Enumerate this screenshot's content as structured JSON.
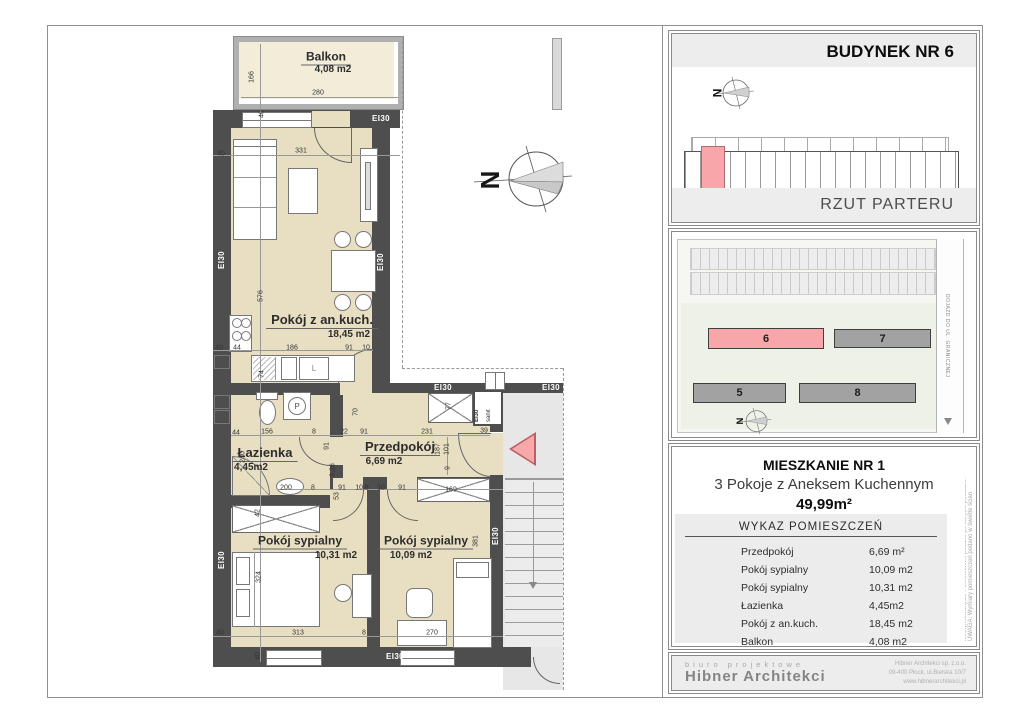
{
  "colors": {
    "highlight_pink": "#f8a6aa",
    "wall_gray": "#4e4e4e",
    "floor_beige": "#e8dfc3"
  },
  "plan": {
    "fire_rating_label": "EI30",
    "sanit_shaft_labels": [
      "EI30",
      "sanit"
    ],
    "north_letter": "N",
    "kitchen_sink_label": "L",
    "washer_label": "P",
    "rooms": [
      {
        "name": "Balkon",
        "area": "4,08 m2",
        "nx": 326,
        "ny": 58,
        "ax": 333,
        "ay": 70,
        "fs": 12
      },
      {
        "name": "Pokój z an.kuch.",
        "area": "18,45 m2",
        "nx": 322,
        "ny": 321,
        "ax": 349,
        "ay": 335,
        "fs": 13
      },
      {
        "name": "Łazienka",
        "area": "4,45m2",
        "nx": 265,
        "ny": 454,
        "ax": 251,
        "ay": 468,
        "fs": 13
      },
      {
        "name": "Przedpokój",
        "area": "6,69 m2",
        "nx": 400,
        "ny": 448,
        "ax": 384,
        "ay": 462,
        "fs": 13
      },
      {
        "name": "Pokój sypialny",
        "area": "10,31 m2",
        "nx": 300,
        "ny": 542,
        "ax": 336,
        "ay": 556,
        "fs": 12
      },
      {
        "name": "Pokój sypialny",
        "area": "10,09 m2",
        "nx": 426,
        "ny": 542,
        "ax": 411,
        "ay": 556,
        "fs": 12
      }
    ],
    "fire_labels": [
      {
        "x": 381,
        "y": 119,
        "r": 0
      },
      {
        "x": 222,
        "y": 260,
        "r": 1
      },
      {
        "x": 381,
        "y": 262,
        "r": 1
      },
      {
        "x": 443,
        "y": 388,
        "r": 0
      },
      {
        "x": 551,
        "y": 388,
        "r": 0
      },
      {
        "x": 222,
        "y": 560,
        "r": 1
      },
      {
        "x": 496,
        "y": 536,
        "r": 1
      },
      {
        "x": 395,
        "y": 657,
        "r": 0
      }
    ],
    "dims": [
      {
        "t": "40",
        "x": 221,
        "y": 154
      },
      {
        "t": "331",
        "x": 301,
        "y": 151
      },
      {
        "t": "166",
        "x": 252,
        "y": 77,
        "r": 1
      },
      {
        "t": "280",
        "x": 318,
        "y": 93
      },
      {
        "t": "40",
        "x": 262,
        "y": 114,
        "r": 1
      },
      {
        "t": "576",
        "x": 261,
        "y": 296,
        "r": 1
      },
      {
        "t": "40",
        "x": 219,
        "y": 348
      },
      {
        "t": "44",
        "x": 237,
        "y": 348
      },
      {
        "t": "186",
        "x": 292,
        "y": 348
      },
      {
        "t": "91",
        "x": 349,
        "y": 348
      },
      {
        "t": "10",
        "x": 366,
        "y": 348
      },
      {
        "t": "74",
        "x": 262,
        "y": 374,
        "r": 1
      },
      {
        "t": "70",
        "x": 356,
        "y": 412,
        "r": 1
      },
      {
        "t": "44",
        "x": 236,
        "y": 433
      },
      {
        "t": "156",
        "x": 267,
        "y": 432
      },
      {
        "t": "8",
        "x": 314,
        "y": 432
      },
      {
        "t": "22",
        "x": 344,
        "y": 432
      },
      {
        "t": "91",
        "x": 364,
        "y": 432
      },
      {
        "t": "231",
        "x": 427,
        "y": 432
      },
      {
        "t": "39",
        "x": 484,
        "y": 431
      },
      {
        "t": "240",
        "x": 243,
        "y": 457,
        "r": 1
      },
      {
        "t": "91",
        "x": 327,
        "y": 446,
        "r": 1
      },
      {
        "t": "8,26",
        "x": 333,
        "y": 470,
        "r": 1
      },
      {
        "t": "53",
        "x": 337,
        "y": 496,
        "r": 1
      },
      {
        "t": "200",
        "x": 286,
        "y": 488
      },
      {
        "t": "8",
        "x": 313,
        "y": 488
      },
      {
        "t": "91",
        "x": 342,
        "y": 488
      },
      {
        "t": "10,8",
        "x": 362,
        "y": 488
      },
      {
        "t": "10",
        "x": 381,
        "y": 488
      },
      {
        "t": "91",
        "x": 402,
        "y": 488
      },
      {
        "t": "187",
        "x": 438,
        "y": 449,
        "r": 1
      },
      {
        "t": "101",
        "x": 447,
        "y": 449,
        "r": 1
      },
      {
        "t": "9",
        "x": 448,
        "y": 468,
        "r": 1
      },
      {
        "t": "77",
        "x": 449,
        "y": 406,
        "r": 1
      },
      {
        "t": "169",
        "x": 451,
        "y": 490
      },
      {
        "t": "42",
        "x": 258,
        "y": 513,
        "r": 1
      },
      {
        "t": "324",
        "x": 259,
        "y": 577,
        "r": 1
      },
      {
        "t": "381",
        "x": 476,
        "y": 541,
        "r": 1
      },
      {
        "t": "40",
        "x": 220,
        "y": 633
      },
      {
        "t": "313",
        "x": 298,
        "y": 633
      },
      {
        "t": "8",
        "x": 364,
        "y": 633
      },
      {
        "t": "270",
        "x": 432,
        "y": 633
      },
      {
        "t": "40",
        "x": 258,
        "y": 656,
        "r": 1
      }
    ]
  },
  "panel_building": {
    "title": "BUDYNEK NR 6",
    "subtitle": "RZUT PARTERU"
  },
  "panel_site": {
    "building_numbers": {
      "b5": "5",
      "b6": "6",
      "b7": "7",
      "b8": "8"
    },
    "road_label": "DOJAZD DO UL. GRANICZNEJ"
  },
  "panel_info": {
    "title": "MIESZKANIE NR 1",
    "subtitle": "3 Pokoje z Aneksem Kuchennym",
    "total_area": "49,99m²",
    "table_title": "WYKAZ POMIESZCZEŃ",
    "rows": [
      {
        "name": "Przedpokój",
        "value": "6,69 m²"
      },
      {
        "name": "Pokój sypialny",
        "value": "10,09 m2"
      },
      {
        "name": "Pokój sypialny",
        "value": "10,31 m2"
      },
      {
        "name": "Łazienka",
        "value": "4,45m2"
      },
      {
        "name": "Pokój z an.kuch.",
        "value": "18,45 m2"
      },
      {
        "name": "Balkon",
        "value": "4,08 m2"
      }
    ],
    "disclaimer": "UWAGA: Wymiary pomieszczeń podano w świetle ścian nieotynkowanych. Powierzchnie podano po obrysie posadzki."
  },
  "footer": {
    "tagline": "biuro projektowe",
    "company": "Hibner Architekci",
    "address_lines": [
      "Hibner Architekci sp. z.o.o.",
      "09-400 Płock, ul.Bielska 10/7",
      "www.hibnerarchitekci.pl"
    ]
  }
}
